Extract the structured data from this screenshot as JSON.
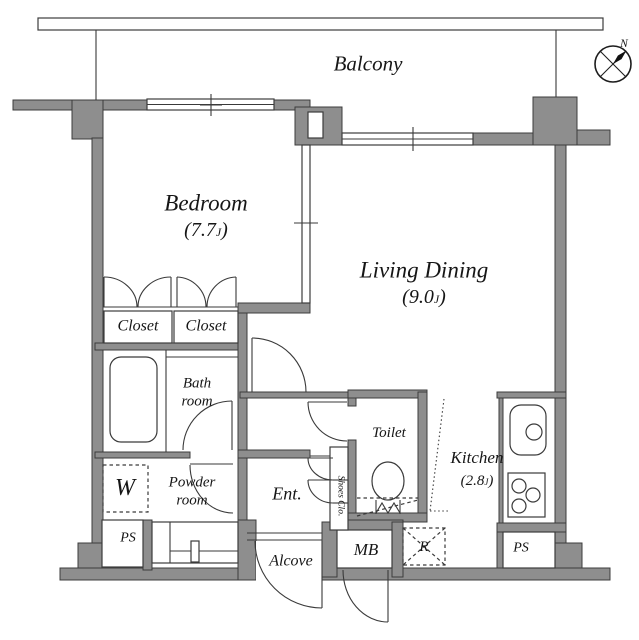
{
  "plan": {
    "balcony": "Balcony",
    "compass": "N",
    "rooms": {
      "bedroom": {
        "name": "Bedroom",
        "area_open": "(7.7",
        "unit": "J",
        "close": ")"
      },
      "living": {
        "name": "Living Dining",
        "area_open": "(9.0",
        "unit": "J",
        "close": ")"
      },
      "kitchen": {
        "name": "Kitchen",
        "area_open": "(2.8",
        "unit": "J",
        "close": ")"
      }
    },
    "labels": {
      "closet1": "Closet",
      "closet2": "Closet",
      "bath1": "Bath",
      "bath2": "room",
      "powder1": "Powder",
      "powder2": "room",
      "toilet": "Toilet",
      "ent": "Ent.",
      "alcove": "Alcove",
      "shoes": "Shoes Clo.",
      "washer": "W",
      "ps_left": "PS",
      "ps_right": "PS",
      "mb": "MB",
      "fridge": "R"
    },
    "colors": {
      "wall": "#8e8e8e",
      "line": "#3a3a3a",
      "bg": "#ffffff"
    }
  }
}
